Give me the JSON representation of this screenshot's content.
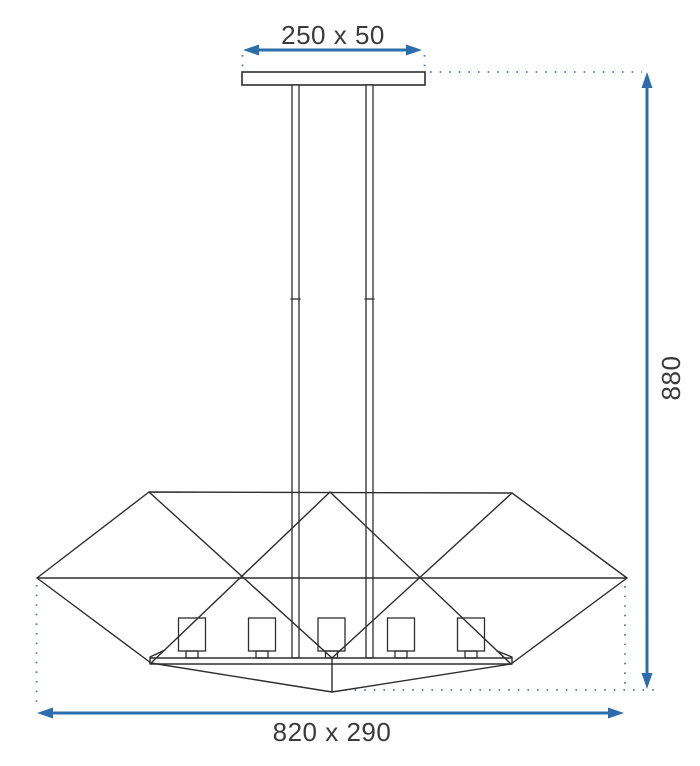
{
  "diagram": {
    "type": "technical-dimension-drawing",
    "subject": "five-light pendant lamp with geometric diamond shade",
    "labels": {
      "canopy": "250 x 50",
      "height": "880",
      "shade": "820 x 290"
    },
    "lamp": {
      "bulb_socket_count": 5,
      "suspension_rod_count": 2
    },
    "colors": {
      "outline": "#2e2e2e",
      "dimension_blue": "#2e6dab",
      "dotted_blue": "#52799f",
      "label_text": "#3b3b3b",
      "background": "#ffffff"
    }
  }
}
